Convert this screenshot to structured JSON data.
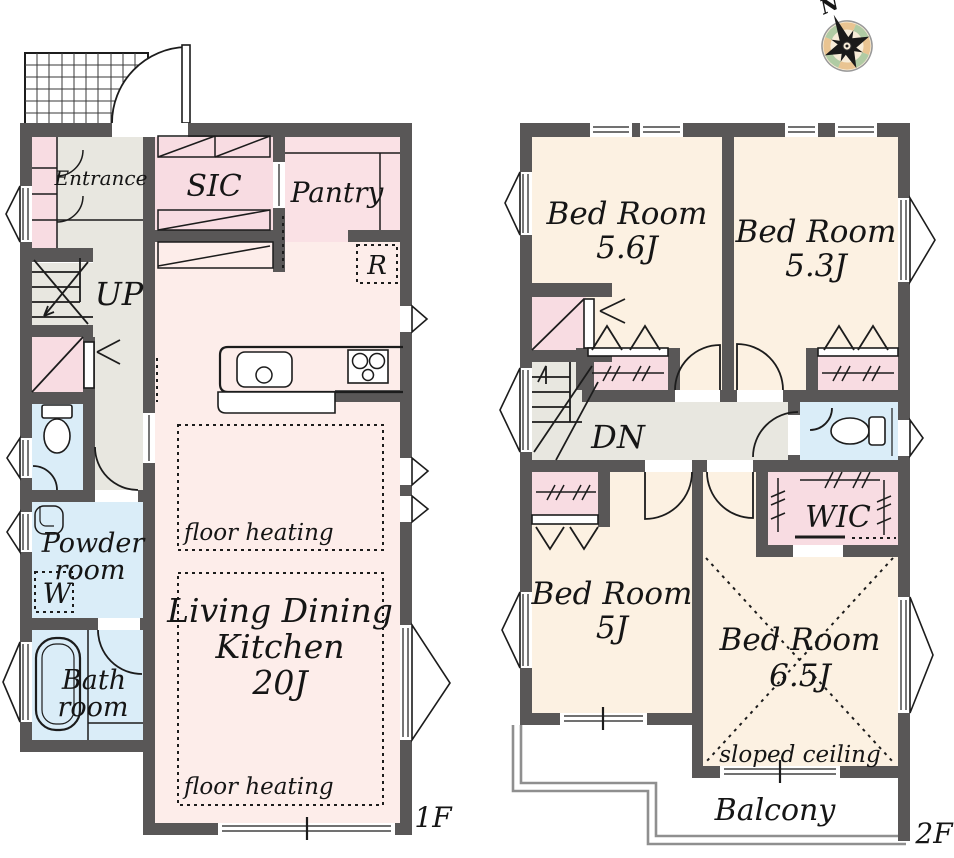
{
  "palette": {
    "wall": "#595757",
    "room_cream": "#fcf1e2",
    "room_pink": "#f8dce2",
    "room_pink_light": "#fdedea",
    "room_gray": "#e8e7e0",
    "room_blue": "#daedf8",
    "balcony_line": "#8f8f8f",
    "compass_peach": "#e9c492",
    "compass_green": "#b0cba4"
  },
  "compass": {
    "north_label": "N"
  },
  "floor1": {
    "floor_label": "1F",
    "entrance": "Entrance",
    "sic": "SIC",
    "pantry": "Pantry",
    "stairs_up": "UP",
    "refrigerator": "R",
    "powder_line1": "Powder",
    "powder_line2": "room",
    "washer": "W",
    "bath_line1": "Bath",
    "bath_line2": "room",
    "ldk_line1": "Living Dining",
    "ldk_line2": "Kitchen",
    "ldk_line3": "20J",
    "floor_heating": "floor heating"
  },
  "floor2": {
    "floor_label": "2F",
    "stairs_down": "DN",
    "wic": "WIC",
    "balcony": "Balcony",
    "sloped_ceiling": "sloped ceiling",
    "bedrooms": [
      {
        "name": "Bed Room",
        "size": "5.6J"
      },
      {
        "name": "Bed Room",
        "size": "5.3J"
      },
      {
        "name": "Bed Room",
        "size": "5J"
      },
      {
        "name": "Bed Room",
        "size": "6.5J"
      }
    ]
  }
}
